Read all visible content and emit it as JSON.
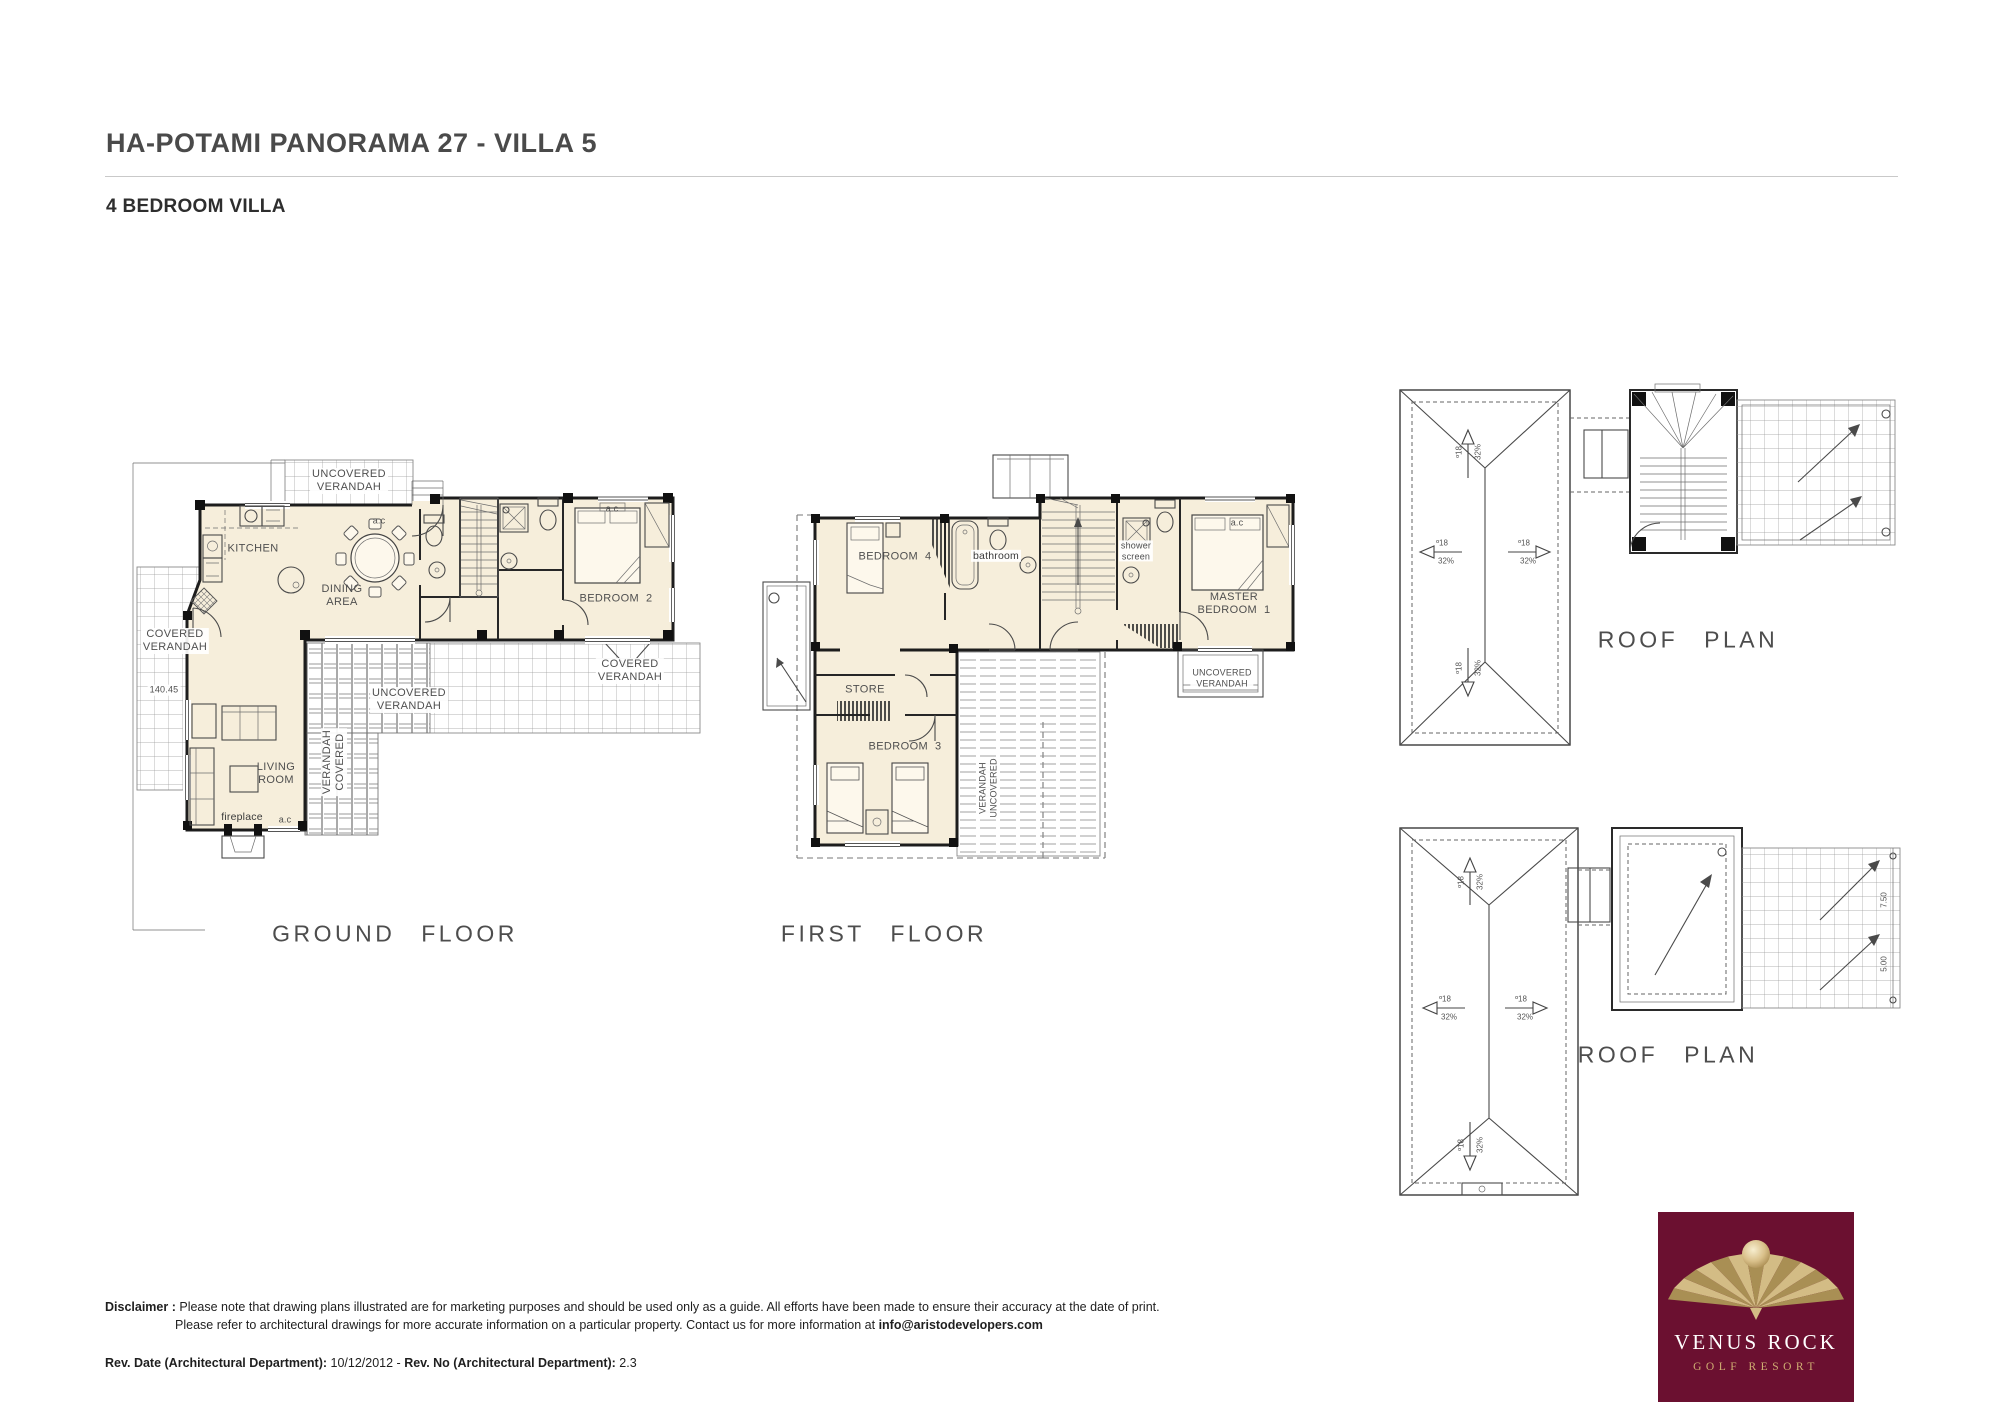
{
  "header": {
    "title": "HA-POTAMI PANORAMA 27 - VILLA 5",
    "subtitle": "4 BEDROOM VILLA"
  },
  "gf": {
    "caption": "GROUND FLOOR",
    "labels": {
      "uv_top": "UNCOVERED\nVERANDAH",
      "kitchen": "KITCHEN",
      "ac_dining": "a.c",
      "dining": "DINING\nAREA",
      "bedroom2": "BEDROOM  2",
      "ac_bedroom2": "a.c",
      "cv_left": "COVERED\nVERANDAH",
      "level": "140.45",
      "living": "LIVING\nROOM",
      "fireplace": "fireplace",
      "ac_living": "a.c",
      "pergola_vertical": "VERANDAH\nCOVERED",
      "uv_mid": "UNCOVERED\nVERANDAH",
      "cv_right": "COVERED\nVERANDAH"
    }
  },
  "ff": {
    "caption": "FIRST FLOOR",
    "labels": {
      "bedroom4": "BEDROOM  4",
      "bathroom": "bathroom",
      "shower_screen": "shower\nscreen",
      "master": "MASTER\nBEDROOM  1",
      "ac_master": "a.c",
      "store": "STORE",
      "bedroom3": "BEDROOM  3",
      "verandah_vertical": "VERANDAH\nUNCOVERED",
      "uv_master": "UNCOVERED\nVERANDAH"
    }
  },
  "roof": {
    "caption": "ROOF PLAN",
    "deg": "º18",
    "pct": "32%",
    "dim1": "7.50",
    "dim2": "5.00"
  },
  "logo": {
    "name": "VENUS ROCK",
    "subtitle": "GOLF RESORT"
  },
  "footer": {
    "disclaimer_label": "Disclaimer :",
    "line1": "Please note that drawing plans illustrated are for marketing purposes and should be used only as a guide. All efforts have been made to ensure their accuracy at the date of print.",
    "line2": "Please refer to architectural drawings for more accurate information on a particular property. Contact us for more information at ",
    "email": "info@aristodevelopers.com",
    "rev_date_label": "Rev. Date (Architectural Department):",
    "rev_date_value": " 10/12/2012 - ",
    "rev_no_label": "Rev. No (Architectural Department):",
    "rev_no_value": " 2.3"
  },
  "colors": {
    "room_fill": "#f6eedb",
    "wall": "#1d1d1d",
    "logo_bg": "#6b1030",
    "logo_gold": "#c9ad74"
  }
}
